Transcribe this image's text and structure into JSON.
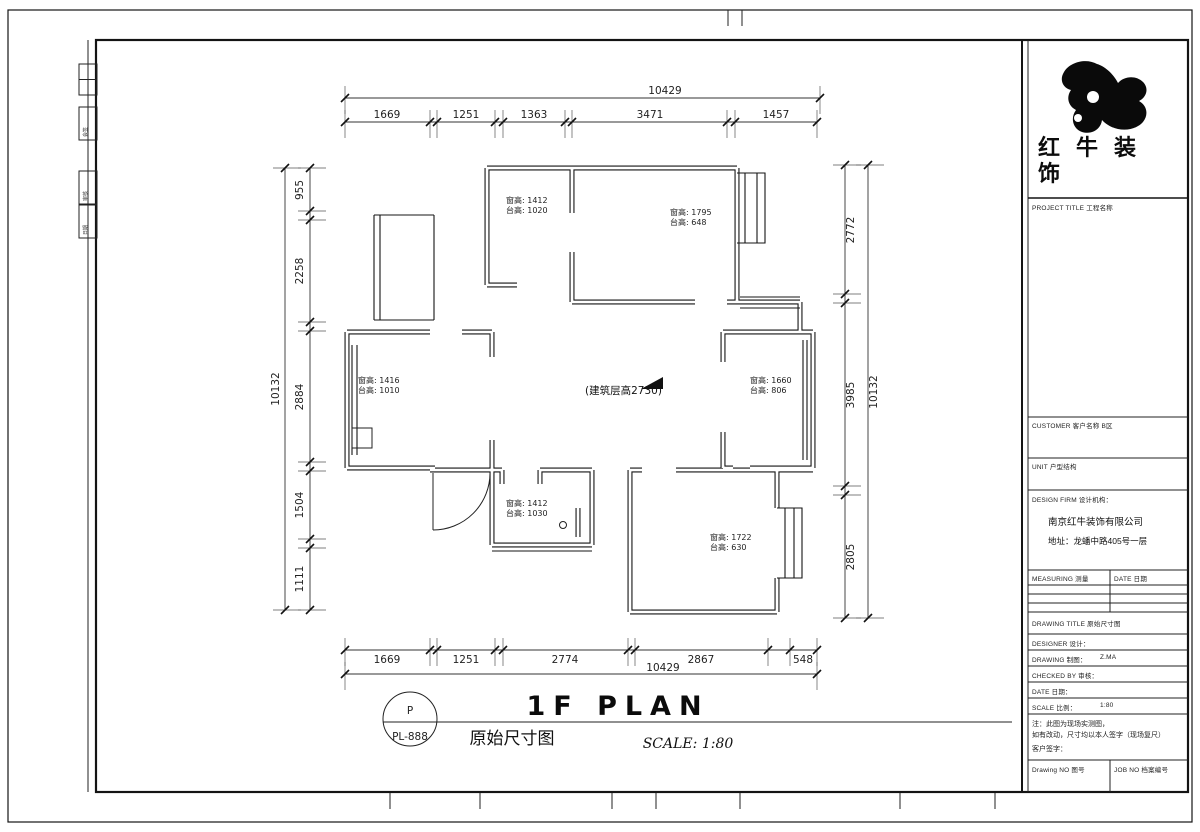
{
  "title_bar": {
    "circle_letter": "P",
    "drawing_no": "PL-888",
    "title_en": "1F PLAN",
    "title_cn": "原始尺寸图",
    "scale_text": "SCALE: 1:80"
  },
  "logo": {
    "company_line1": "红牛装",
    "company_line2": "饰"
  },
  "title_block": {
    "project_title_label": "PROJECT TITLE  工程名称",
    "customer_label": "CUSTOMER  客户名称  B区",
    "layout_label": "UNIT  户型结构",
    "firm_label": "DESIGN FIRM  设计机构：",
    "firm_name": "南京红牛装饰有限公司",
    "firm_address": "地址：龙蟠中路405号一层",
    "measure_label": "MEASURING  测量",
    "measure_date_label": "DATE  日期",
    "drawing_title_label": "DRAWING TITLE  原始尺寸图",
    "designer_label": "DESIGNER  设计：",
    "drawing_label": "DRAWING  制图：",
    "drawing_value": "Z.MA",
    "checked_label": "CHECKED BY  审核：",
    "date_label": "DATE  日期：",
    "scale_label": "SCALE  比例：",
    "scale_value": "1:80",
    "notes_line1": "注：此图为现场实测图，",
    "notes_line2": "如有改动，尺寸均以本人签字（现场复尺）",
    "notes_line3": "客户签字：",
    "drawing_no_label": "Drawing NO  图号",
    "job_no_label": "JOB NO  档案编号"
  },
  "signoff_strip": {
    "cells": [
      "会签",
      "审核",
      "日期"
    ]
  },
  "plan": {
    "floor_height_note": "(建筑层高2730)",
    "dims_top": {
      "overall": "10429",
      "segments": [
        "1669",
        "1251",
        "1363",
        "3471",
        "1457"
      ]
    },
    "dims_bottom": {
      "overall": "10429",
      "segments": [
        "1669",
        "1251",
        "2774",
        "2867",
        "548"
      ]
    },
    "dims_left": {
      "overall": "10132",
      "segments": [
        "955",
        "2258",
        "2884",
        "1504",
        "1111"
      ]
    },
    "dims_right": {
      "overall": "10132",
      "segments": [
        "2772",
        "3985",
        "2805"
      ]
    },
    "window_labels": [
      {
        "l1": "窗高: 1412",
        "l2": "台高: 1020"
      },
      {
        "l1": "窗高: 1795",
        "l2": "台高: 648"
      },
      {
        "l1": "窗高: 1416",
        "l2": "台高: 1010"
      },
      {
        "l1": "窗高: 1660",
        "l2": "台高: 806"
      },
      {
        "l1": "窗高: 1412",
        "l2": "台高: 1030"
      },
      {
        "l1": "窗高: 1722",
        "l2": "台高: 630"
      }
    ]
  }
}
